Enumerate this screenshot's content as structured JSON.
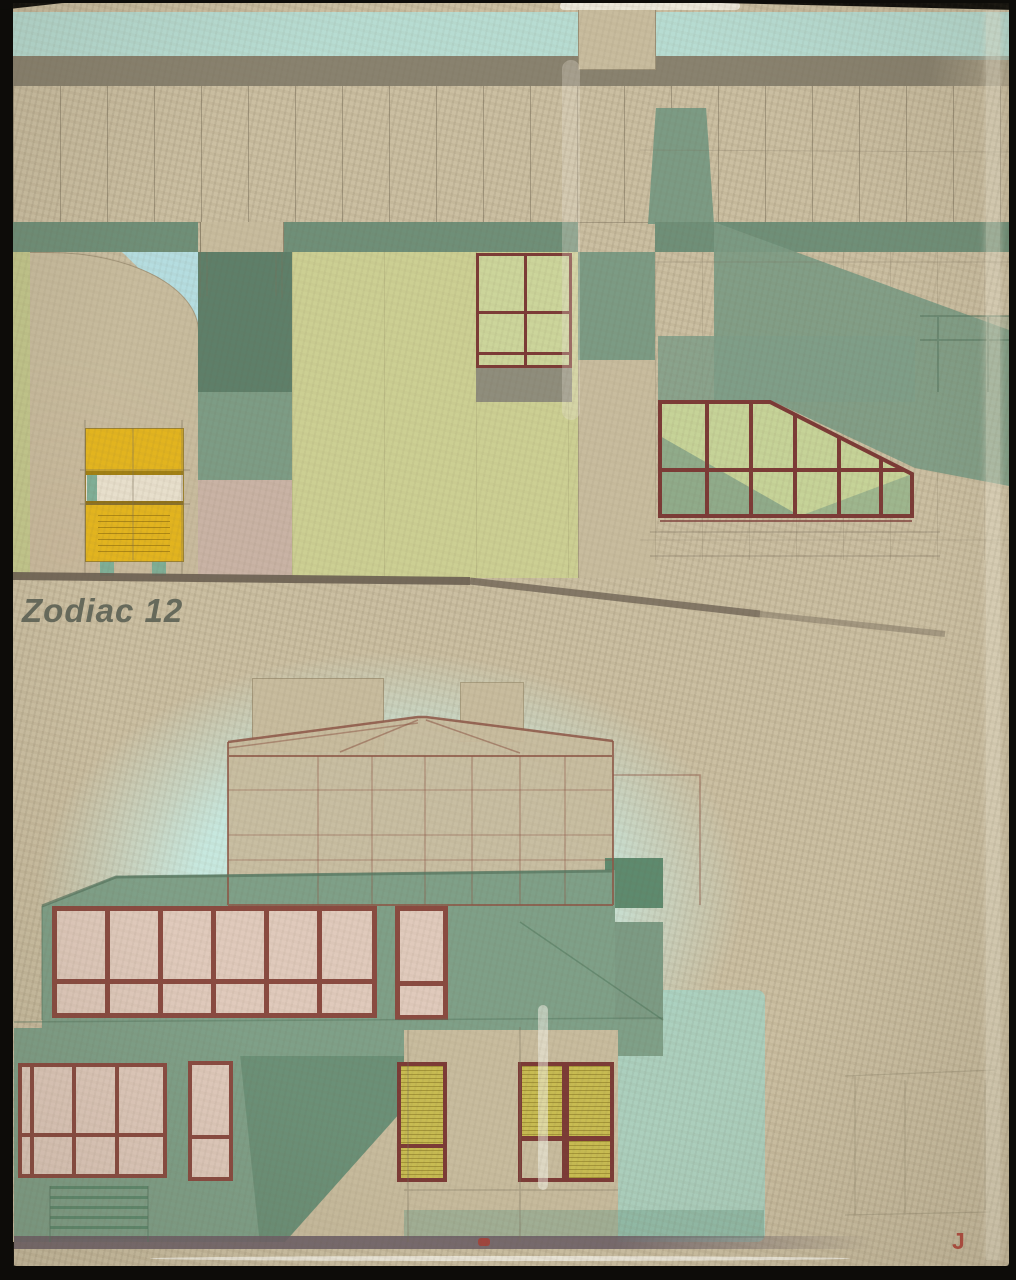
{
  "cover": {
    "title": "Zodiac 12",
    "corner_mark": "J"
  },
  "colors": {
    "paper": "#cbbfa2",
    "paper2": "#c8bc9e",
    "sky": "#b7dcd2",
    "grayband": "#89826f",
    "greenband": "#6f8f78",
    "greenmass": "#7c9b84",
    "pillar": "#5e7f69",
    "pillarlight": "#7d9c85",
    "pinkwall": "#c9b3a5",
    "chartreuse": "#cccf93",
    "leftstrip": "#c2c68c",
    "bluetri": "#b5dde0",
    "maroon": "#7c3a36",
    "glassgreen": "#ccd59b",
    "graypanel": "#8f8d7c",
    "conglass": "#c6d398",
    "kioskyellow": "#e2b41f",
    "kioskwhite": "#e7dfcc",
    "kiosklegs": "#7fae96",
    "ground": "#6b6052",
    "titlecol": "#666a5c",
    "cyanwash": "#c7e8df",
    "cyanband": "#9ed6c9",
    "pencil": "#8d5646",
    "lowgreen": "#7fa088",
    "lowgreendark": "#5e8a6e",
    "pinkglass": "#e0cabc",
    "lowmaroon": "#8a4a40",
    "yellowglass": "#c8bc52",
    "groundstrip": "#6e6168",
    "redmark": "#b0392f",
    "black": "#0d0c09"
  }
}
